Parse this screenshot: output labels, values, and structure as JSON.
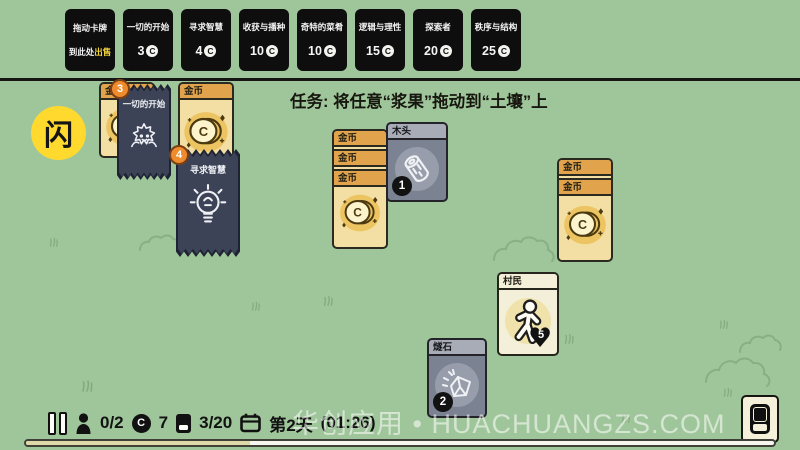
{
  "topbar": {
    "sell_card": {
      "line1": "拖动卡牌",
      "line2_prefix": "到此处",
      "line2_highlight": "出售"
    },
    "coin_letter": "C",
    "packs": [
      {
        "title": "一切的开始",
        "price": "3"
      },
      {
        "title": "寻求智慧",
        "price": "4"
      },
      {
        "title": "收获与播种",
        "price": "10"
      },
      {
        "title": "奇特的菜肴",
        "price": "10"
      },
      {
        "title": "逻辑与理性",
        "price": "15"
      },
      {
        "title": "探索者",
        "price": "20"
      },
      {
        "title": "秩序与结构",
        "price": "25"
      }
    ]
  },
  "board": {
    "task": "任务: 将任意“浆果”拖动到“土壤”上",
    "coin_card_title": "金币",
    "pack_a": {
      "title": "一切的开始",
      "badge": "3"
    },
    "pack_b": {
      "title": "寻求智慧",
      "badge": "4"
    },
    "wood_card": {
      "title": "木头",
      "count": "1"
    },
    "flint_card": {
      "title": "燧石",
      "count": "2"
    },
    "villager_card": {
      "title": "村民",
      "health": "5"
    }
  },
  "hud": {
    "villagers": "0/2",
    "coins": "7",
    "cards": "3/20",
    "day": "第2天",
    "time": "(01:26)",
    "coin_letter": "C",
    "day_progress_pct": 30
  },
  "watermark": {
    "logo_text": "闪",
    "site_text": "华创应用 • HUACHUANGZS.COM"
  },
  "colors": {
    "board_green": "#9fc69a",
    "topcard_black": "#0e0e0e",
    "highlight_yellow": "#f2d43c",
    "gold_header": "#e1a34b",
    "gold_body": "#f3dfa3",
    "gray_body": "#7b8393",
    "gray_header": "#a7acb7",
    "cream_body": "#f4efd8",
    "pack_navy": "#3d4357",
    "pack_badge_orange": "#ed8b2d",
    "logo_yellow": "#ffd92e"
  }
}
